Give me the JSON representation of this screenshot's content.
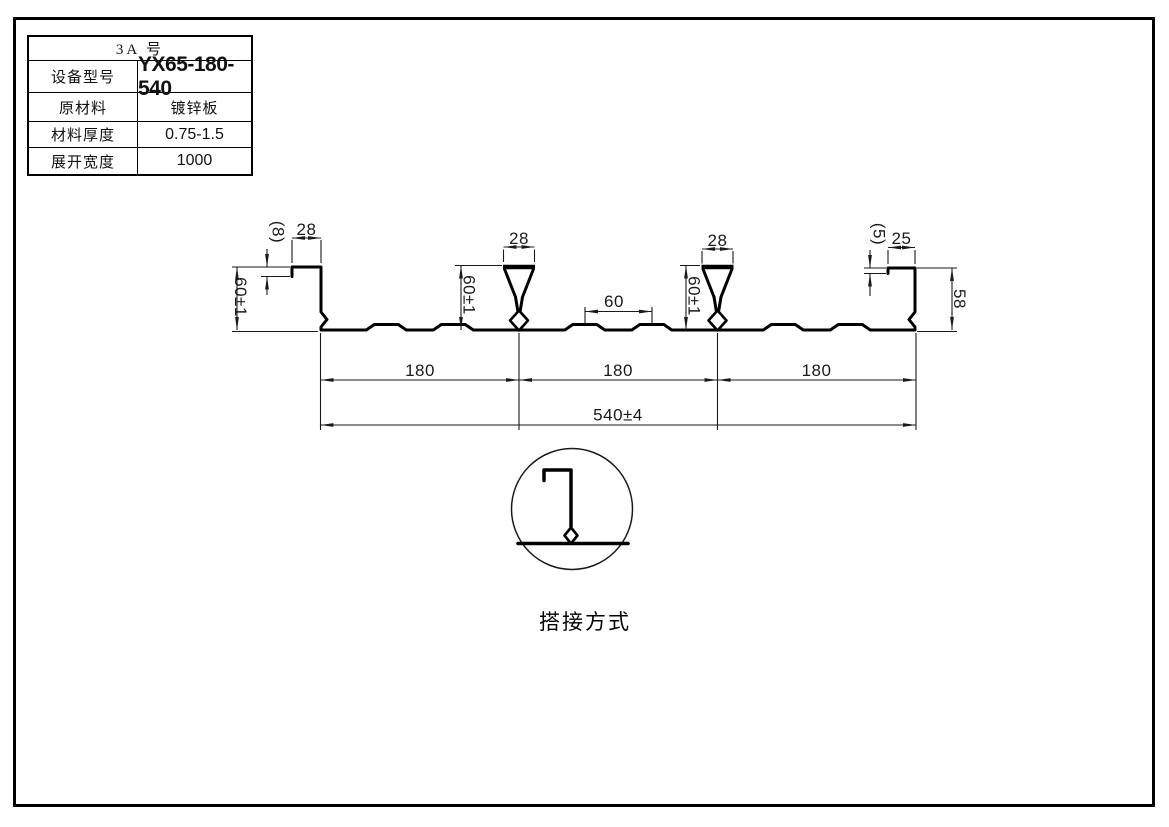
{
  "page": {
    "background": "#ffffff",
    "border_color": "#000000",
    "line_color": "#000000"
  },
  "spec_table": {
    "title": "3A 号",
    "rows": [
      {
        "label": "设备型号",
        "value": "YX65-180-540"
      },
      {
        "label": "原材料",
        "value": "镀锌板"
      },
      {
        "label": "材料厚度",
        "value": "0.75-1.5"
      },
      {
        "label": "展开宽度",
        "value": "1000"
      }
    ]
  },
  "drawing": {
    "dims": {
      "left_lip_drop": "(8)",
      "left_lip_width": "28",
      "left_edge_height": "60±1",
      "rib1_top_width": "28",
      "rib1_height": "60±1",
      "groove_gap": "60",
      "rib2_top_width": "28",
      "rib2_height": "60±1",
      "right_lip_drop": "(5)",
      "right_lip_width": "25",
      "right_edge_height": "58",
      "pitch_1": "180",
      "pitch_2": "180",
      "pitch_3": "180",
      "overall_width": "540±4"
    },
    "detail_label": "搭接方式"
  }
}
